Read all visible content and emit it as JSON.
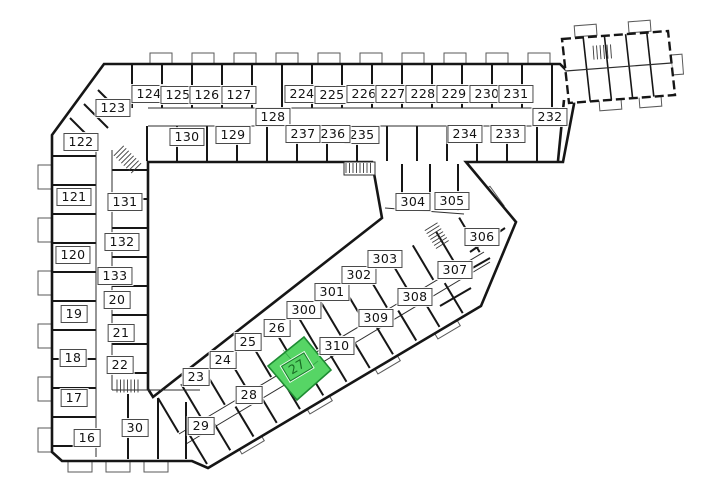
{
  "plan": {
    "type": "building-floor-plan",
    "selected_room": "27",
    "colors": {
      "wall": "#161616",
      "thin_wall": "#2e2e2e",
      "bay_stroke": "#5a5a5a",
      "highlight_fill": "#56d565",
      "highlight_stroke": "#1e8c33",
      "highlight_text": "#186c24"
    },
    "rooms": [
      {
        "number": "16",
        "x": 87,
        "y": 438
      },
      {
        "number": "17",
        "x": 74,
        "y": 398
      },
      {
        "number": "18",
        "x": 73,
        "y": 358
      },
      {
        "number": "19",
        "x": 74,
        "y": 314
      },
      {
        "number": "20",
        "x": 117,
        "y": 300
      },
      {
        "number": "21",
        "x": 121,
        "y": 333
      },
      {
        "number": "22",
        "x": 120,
        "y": 365
      },
      {
        "number": "23",
        "x": 196,
        "y": 377
      },
      {
        "number": "24",
        "x": 223,
        "y": 360
      },
      {
        "number": "25",
        "x": 248,
        "y": 342
      },
      {
        "number": "26",
        "x": 277,
        "y": 328
      },
      {
        "number": "27",
        "x": 297,
        "y": 367,
        "highlighted": true,
        "rotation": -31
      },
      {
        "number": "28",
        "x": 249,
        "y": 395
      },
      {
        "number": "29",
        "x": 201,
        "y": 426
      },
      {
        "number": "30",
        "x": 135,
        "y": 428
      },
      {
        "number": "120",
        "x": 73,
        "y": 255
      },
      {
        "number": "121",
        "x": 74,
        "y": 197
      },
      {
        "number": "122",
        "x": 81,
        "y": 142
      },
      {
        "number": "123",
        "x": 113,
        "y": 108
      },
      {
        "number": "124",
        "x": 149,
        "y": 94
      },
      {
        "number": "125",
        "x": 178,
        "y": 95
      },
      {
        "number": "126",
        "x": 207,
        "y": 95
      },
      {
        "number": "127",
        "x": 239,
        "y": 95
      },
      {
        "number": "128",
        "x": 273,
        "y": 117
      },
      {
        "number": "129",
        "x": 233,
        "y": 135
      },
      {
        "number": "130",
        "x": 187,
        "y": 137
      },
      {
        "number": "131",
        "x": 125,
        "y": 202
      },
      {
        "number": "132",
        "x": 122,
        "y": 242
      },
      {
        "number": "133",
        "x": 115,
        "y": 276
      },
      {
        "number": "224",
        "x": 302,
        "y": 94
      },
      {
        "number": "225",
        "x": 332,
        "y": 95
      },
      {
        "number": "226",
        "x": 364,
        "y": 94
      },
      {
        "number": "227",
        "x": 393,
        "y": 94
      },
      {
        "number": "228",
        "x": 423,
        "y": 94
      },
      {
        "number": "229",
        "x": 454,
        "y": 94
      },
      {
        "number": "230",
        "x": 487,
        "y": 94
      },
      {
        "number": "231",
        "x": 516,
        "y": 94
      },
      {
        "number": "232",
        "x": 550,
        "y": 117
      },
      {
        "number": "233",
        "x": 508,
        "y": 134
      },
      {
        "number": "234",
        "x": 465,
        "y": 134
      },
      {
        "number": "235",
        "x": 362,
        "y": 135
      },
      {
        "number": "236",
        "x": 333,
        "y": 134
      },
      {
        "number": "237",
        "x": 303,
        "y": 134
      },
      {
        "number": "300",
        "x": 304,
        "y": 310
      },
      {
        "number": "301",
        "x": 332,
        "y": 292
      },
      {
        "number": "302",
        "x": 359,
        "y": 275
      },
      {
        "number": "303",
        "x": 385,
        "y": 259
      },
      {
        "number": "304",
        "x": 413,
        "y": 202
      },
      {
        "number": "305",
        "x": 452,
        "y": 201
      },
      {
        "number": "306",
        "x": 482,
        "y": 237
      },
      {
        "number": "307",
        "x": 455,
        "y": 270
      },
      {
        "number": "308",
        "x": 415,
        "y": 297
      },
      {
        "number": "309",
        "x": 376,
        "y": 318
      },
      {
        "number": "310",
        "x": 337,
        "y": 346
      }
    ]
  }
}
